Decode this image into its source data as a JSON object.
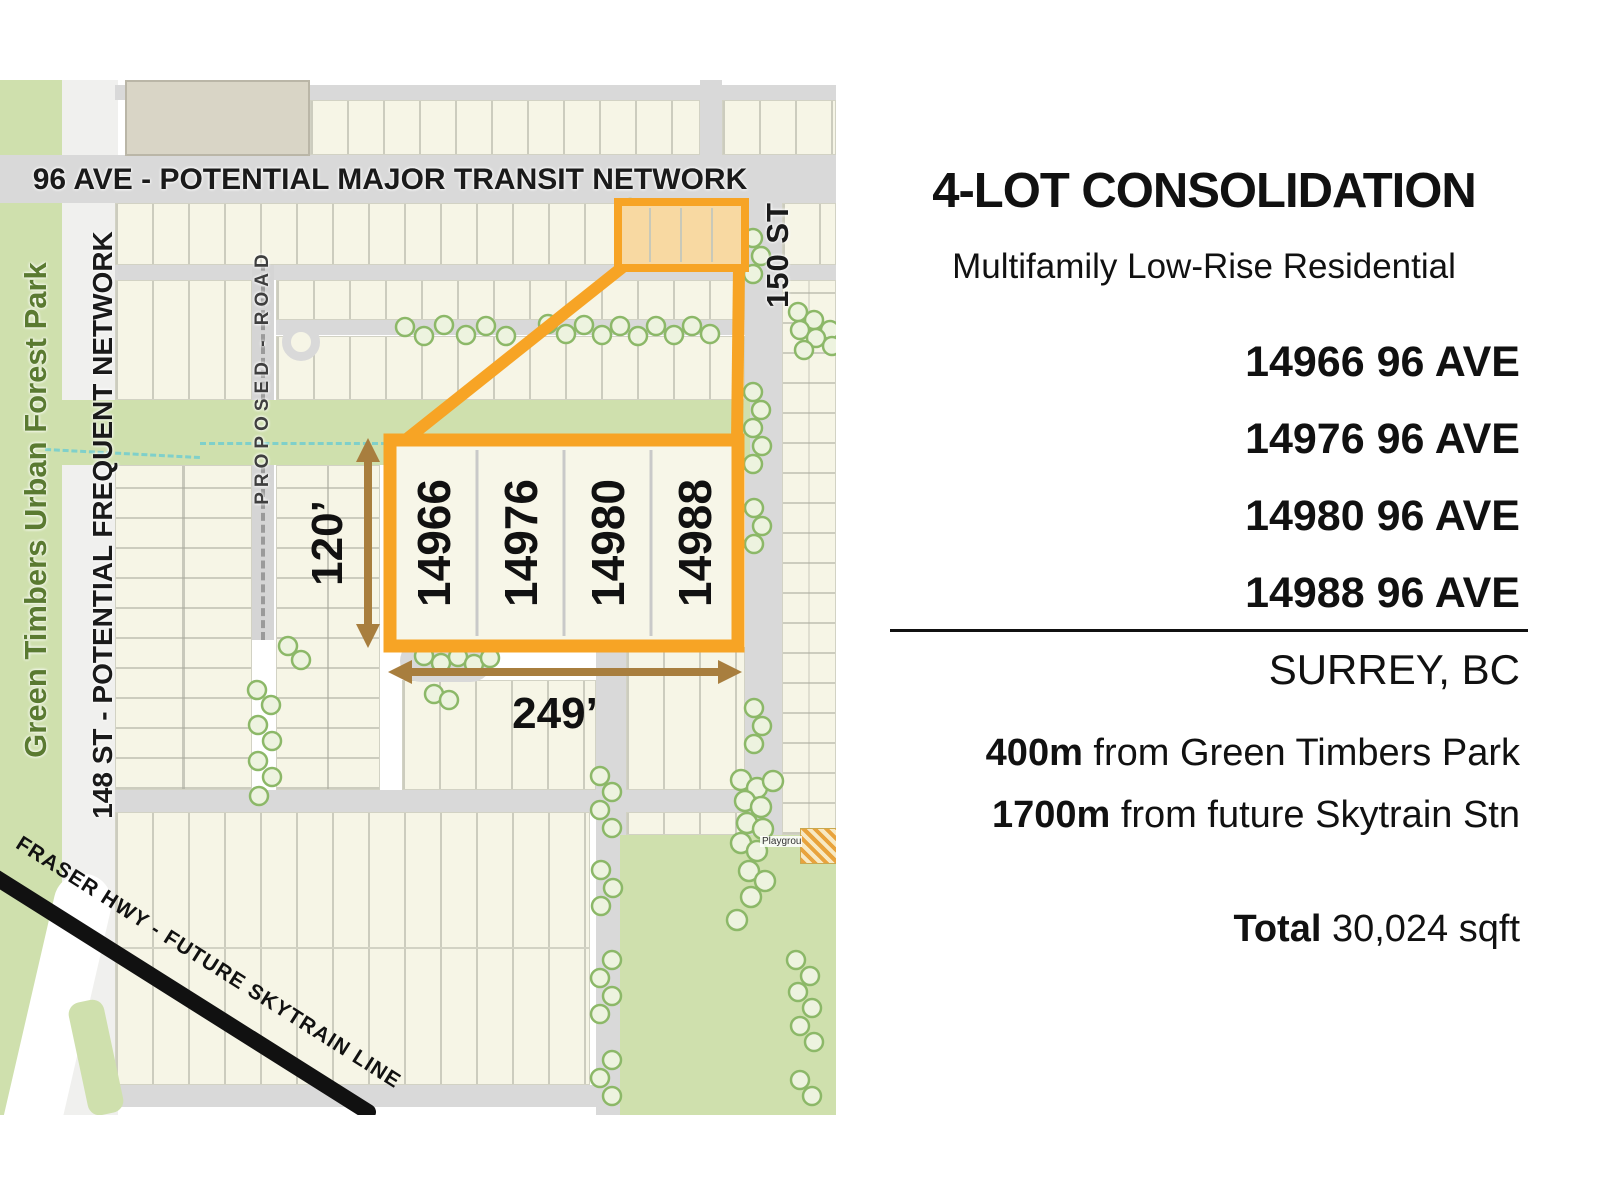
{
  "map": {
    "labels": {
      "ave96": "96 AVE - POTENTIAL MAJOR TRANSIT NETWORK",
      "st148": "148  ST - POTENTIAL FREQUENT NETWORK",
      "park": "Green Timbers Urban Forest Park",
      "proposed": "PROPOSED - ROAD",
      "st150": "150 ST",
      "fraser": "FRASER HWY - FUTURE SKYTRAIN LINE",
      "playground": "Playground"
    },
    "lots": [
      "14966",
      "14976",
      "14980",
      "14988"
    ],
    "dimensions": {
      "depth": "120’",
      "width": "249’"
    }
  },
  "panel": {
    "title": "4-LOT CONSOLIDATION",
    "subtitle": "Multifamily Low-Rise Residential",
    "addresses": [
      "14966 96 AVE",
      "14976 96 AVE",
      "14980 96 AVE",
      "14988 96 AVE"
    ],
    "city": "SURREY, BC",
    "distances": [
      {
        "value": "400m",
        "rest": " from Green Timbers Park"
      },
      {
        "value": "1700m",
        "rest": " from future Skytrain Stn"
      }
    ],
    "total": {
      "label": "Total",
      "value": " 30,024 sqft"
    }
  },
  "colors": {
    "accent_orange": "#F7A425",
    "lot_highlight_fill": "#F8D9A2",
    "park_green": "#CFE0AD",
    "arrow_brown": "#A87E3E",
    "park_label_green": "#5A7A31",
    "road_gray": "#D9D9D9",
    "skytrain_black": "#111111"
  }
}
